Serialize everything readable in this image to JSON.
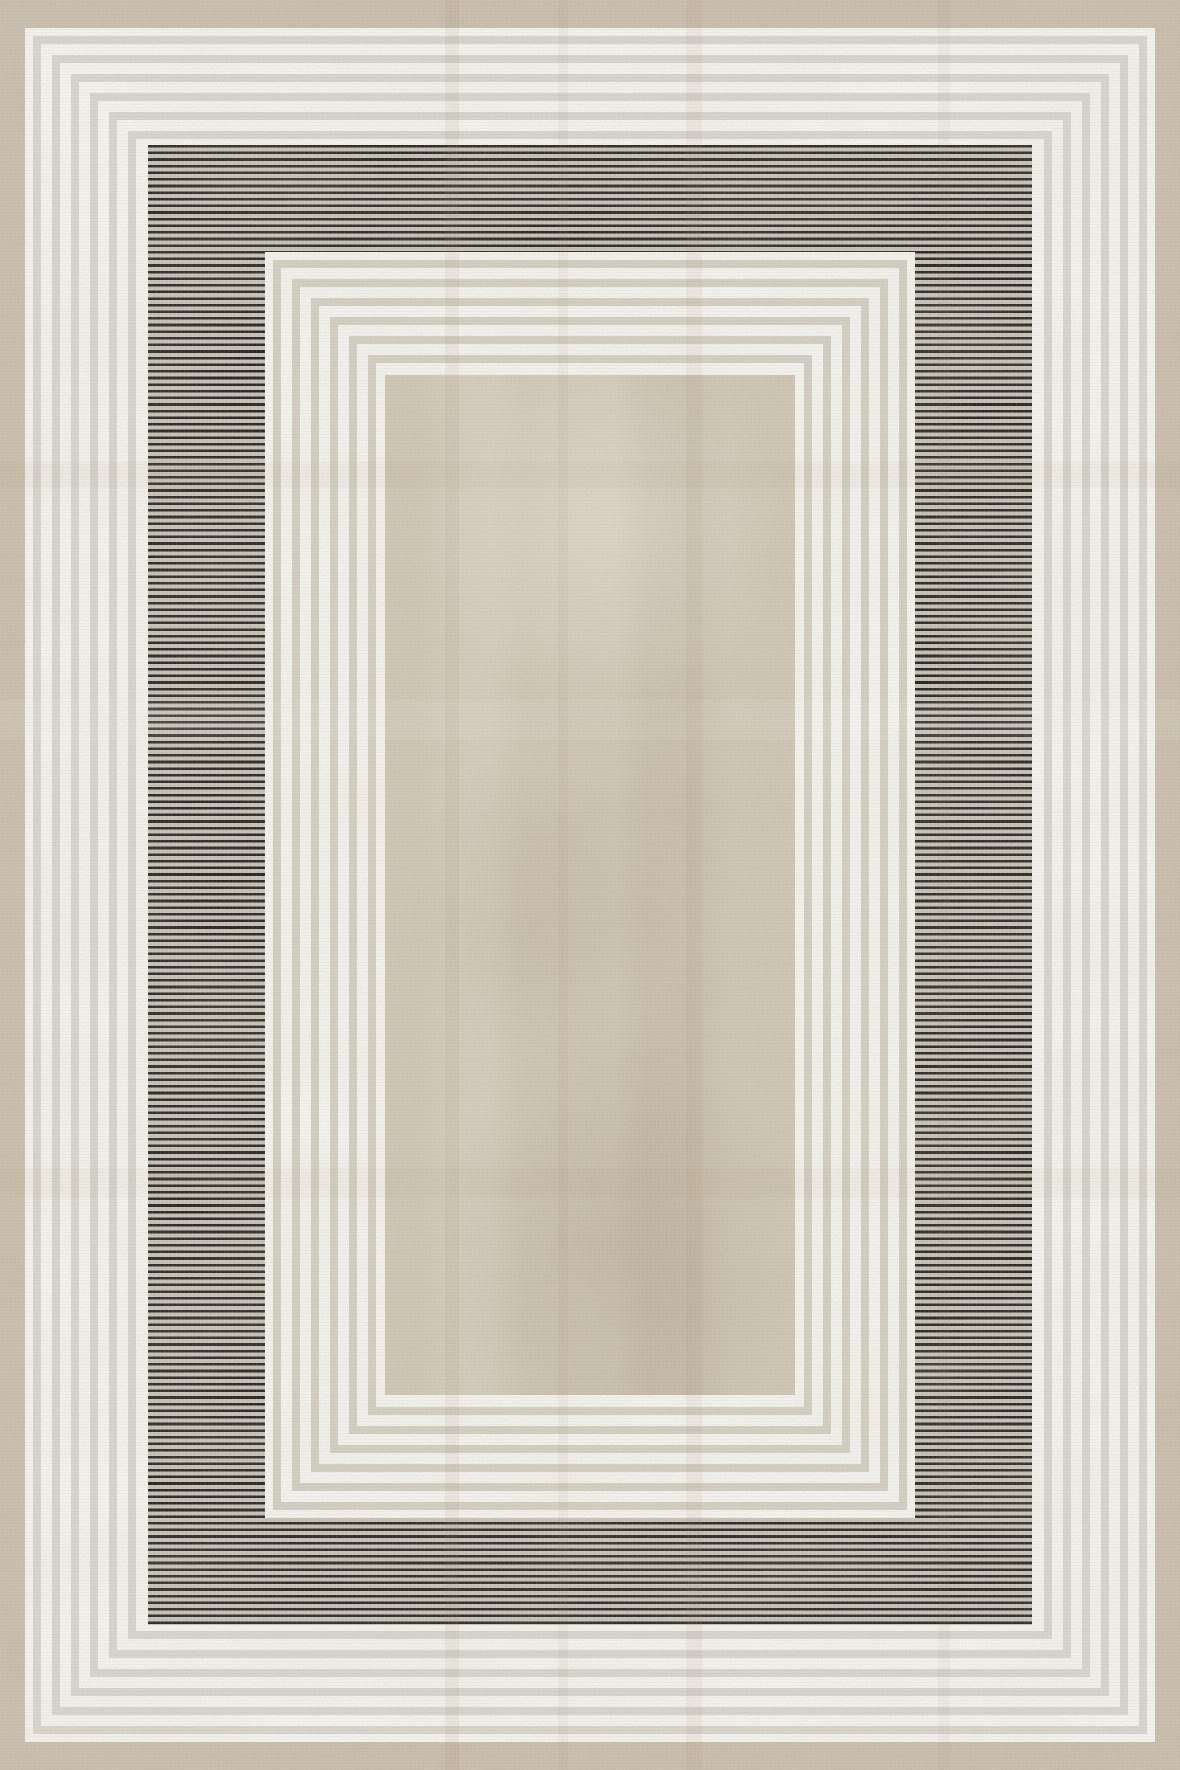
{
  "rug": {
    "width": 1180,
    "height": 1770,
    "palette": {
      "border_beige": "#c9bdab",
      "frame_white": "#f7f6f2",
      "groove_gray": "#d8d6d0",
      "groove_warm": "#d4cfc4",
      "stripe_black": "#1d1b18",
      "stripe_gap": "#c6c1b7",
      "center_beige": "#cfc5b3"
    },
    "outer_border": {
      "left": 25,
      "top": 28,
      "right": 25,
      "bottom": 28
    },
    "frames": [
      {
        "name": "outer-pinstripe-frame",
        "inset": {
          "left": 25,
          "top": 28,
          "right": 25,
          "bottom": 28
        },
        "groove_color_key": "groove_gray",
        "rings": {
          "count": 6,
          "first_pad": 8,
          "groove": 8,
          "ridge": 11
        }
      },
      {
        "name": "inner-pinstripe-frame",
        "inset": {
          "left": 265,
          "top": 252,
          "right": 265,
          "bottom": 252
        },
        "groove_color_key": "groove_warm",
        "rings": {
          "count": 6,
          "first_pad": 8,
          "groove": 8,
          "ridge": 11
        }
      }
    ],
    "black_band": {
      "inset": {
        "left": 148,
        "top": 145,
        "right": 148,
        "bottom": 145
      },
      "stripe_period_px": 6.62,
      "stripe_line_px": 2.6,
      "direction": "horizontal"
    },
    "center_field": {
      "inset": {
        "left": 385,
        "top": 375,
        "right": 385,
        "bottom": 375
      }
    }
  }
}
